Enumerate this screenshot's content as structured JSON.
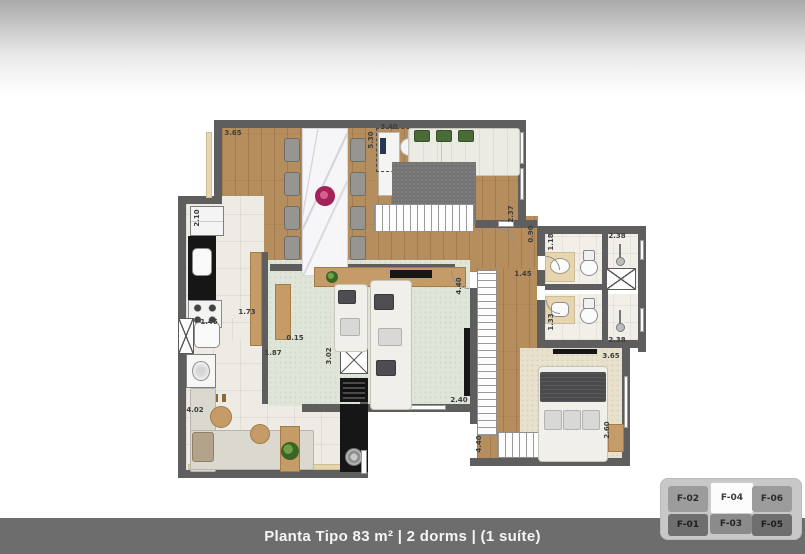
{
  "footer": {
    "title": "Planta Tipo 83 m² | 2 dorms | (1 suíte)"
  },
  "floorplan": {
    "dimensions": [
      {
        "text": "3.65",
        "x": 54,
        "y": 17,
        "rot": false
      },
      {
        "text": "2.10",
        "x": 18,
        "y": 102,
        "rot": true
      },
      {
        "text": "1.73",
        "x": 68,
        "y": 196,
        "rot": false
      },
      {
        "text": "1.46",
        "x": 30,
        "y": 206,
        "rot": false
      },
      {
        "text": "4.02",
        "x": 16,
        "y": 294,
        "rot": false
      },
      {
        "text": "1.87",
        "x": 94,
        "y": 237,
        "rot": false
      },
      {
        "text": "3.02",
        "x": 150,
        "y": 240,
        "rot": true
      },
      {
        "text": "0.15",
        "x": 116,
        "y": 222,
        "rot": false
      },
      {
        "text": "5.30",
        "x": 192,
        "y": 24,
        "rot": true
      },
      {
        "text": "3.40",
        "x": 210,
        "y": 11,
        "rot": false
      },
      {
        "text": "2.37",
        "x": 332,
        "y": 98,
        "rot": true
      },
      {
        "text": "0.90",
        "x": 352,
        "y": 118,
        "rot": true
      },
      {
        "text": "1.45",
        "x": 344,
        "y": 158,
        "rot": false
      },
      {
        "text": "1.18",
        "x": 372,
        "y": 126,
        "rot": true
      },
      {
        "text": "2.38",
        "x": 438,
        "y": 120,
        "rot": false
      },
      {
        "text": "1.33",
        "x": 372,
        "y": 206,
        "rot": true
      },
      {
        "text": "2.38",
        "x": 438,
        "y": 224,
        "rot": false
      },
      {
        "text": "3.65",
        "x": 432,
        "y": 240,
        "rot": false
      },
      {
        "text": "2.60",
        "x": 428,
        "y": 314,
        "rot": true
      },
      {
        "text": "4.40",
        "x": 300,
        "y": 328,
        "rot": true
      },
      {
        "text": "4.40",
        "x": 280,
        "y": 170,
        "rot": true
      },
      {
        "text": "2.40",
        "x": 280,
        "y": 284,
        "rot": false
      }
    ]
  },
  "keyplan": {
    "units": [
      {
        "id": "F-02",
        "highlight": false
      },
      {
        "id": "F-04",
        "highlight": true
      },
      {
        "id": "F-06",
        "highlight": false
      },
      {
        "id": "F-01",
        "highlight": false
      },
      {
        "id": "F-03",
        "highlight": false
      },
      {
        "id": "F-05",
        "highlight": false
      }
    ]
  },
  "colors": {
    "wall": "#5e5e5e",
    "wood_floor": "#b68e5e",
    "mint_carpet": "#dfe5d8",
    "suite_carpet": "#e8e1cd",
    "footer_bar": "#6d6d6d",
    "highlight_unit": "#fcfcfc",
    "accent_flower": "#a42257"
  }
}
